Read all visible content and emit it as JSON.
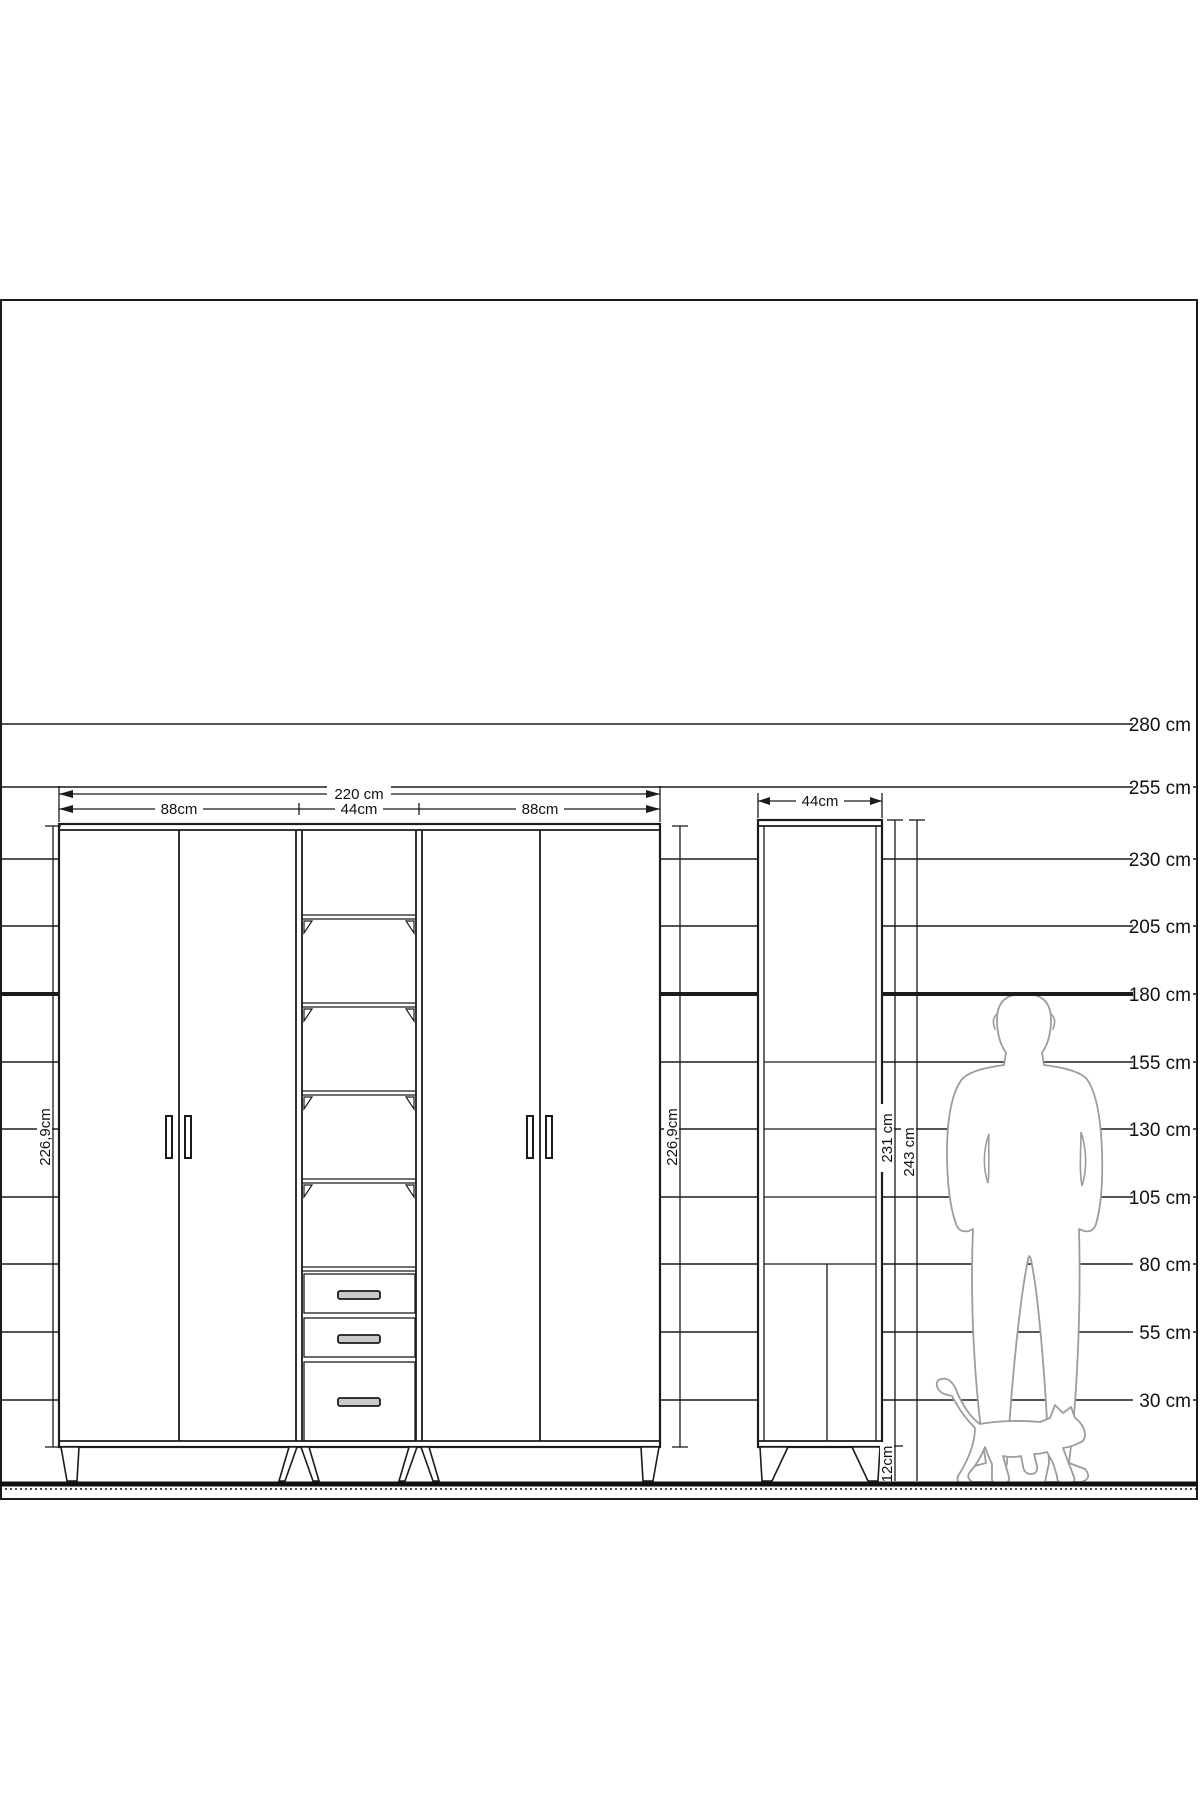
{
  "colors": {
    "line": "#1b1b1b",
    "figure": "#9c9c9c",
    "handle": "#c9c9c9",
    "floor": "#111111",
    "background": "#ffffff"
  },
  "ruler": {
    "labels": [
      "280 cm",
      "255 cm",
      "230 cm",
      "205 cm",
      "180 cm",
      "155 cm",
      "130 cm",
      "105 cm",
      "80 cm",
      "55 cm",
      "30 cm"
    ],
    "bold_label": "180 cm"
  },
  "wardrobe": {
    "width_total": "220 cm",
    "width_left": "88cm",
    "width_middle": "44cm",
    "width_right": "88cm",
    "height_left": "226,9cm",
    "height_right": "226,9cm"
  },
  "cabinet": {
    "width": "44cm",
    "body_height": "231 cm",
    "total_height": "243 cm",
    "leg_height": "12cm"
  }
}
